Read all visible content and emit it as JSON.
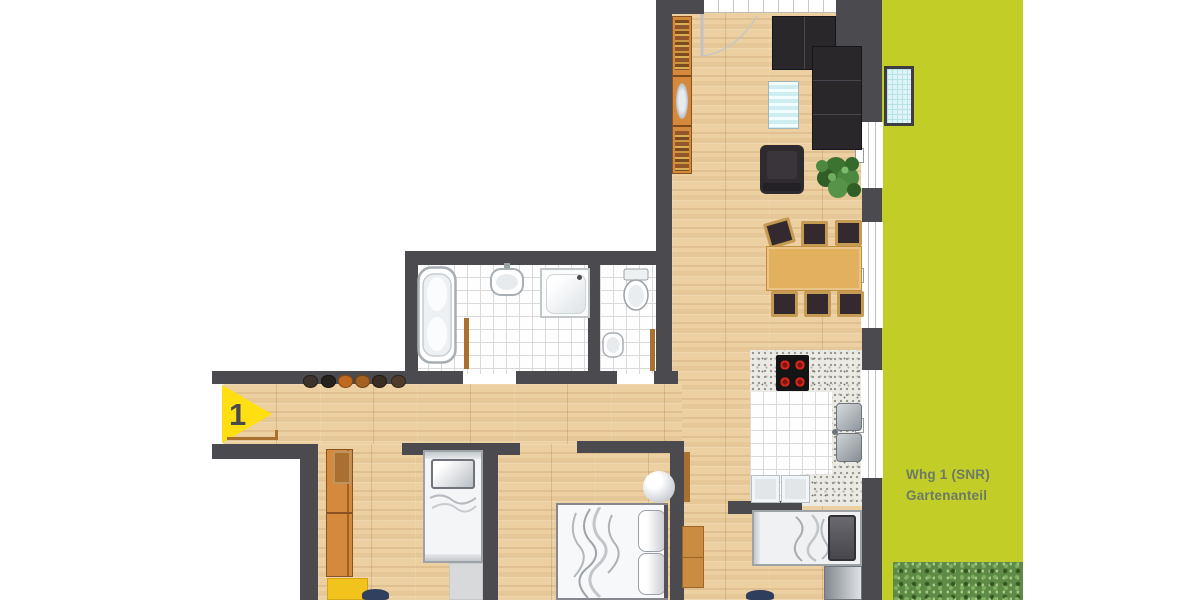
{
  "labels": {
    "unit_marker": "1",
    "garden_line1": "Whg 1 (SNR)",
    "garden_line2": "Gartenanteil"
  },
  "colors": {
    "wall": "#4b4a4f",
    "wood": "#ecd0a2",
    "garden": "#c2cd28",
    "garden-label": "#6d7a67",
    "hedge": "#5d8a44",
    "marker-yellow": "#ffdf12",
    "marker-number": "#4a4a4e",
    "tile-line": "#dadada",
    "granite": "#eceae4",
    "door-wood": "#a9702f",
    "sofa": "#2a272b",
    "chair-seat": "#33292e",
    "chair-frame": "#c59a52",
    "table-wood": "#e2b15e",
    "wardrobe-orange": "#d5893c",
    "desk-yellow": "#f2c31d",
    "lightwell-blue": "#dff4f7"
  },
  "elements": [
    "entrance-marker",
    "garden-area",
    "hedge",
    "light-well",
    "corner-sofa",
    "coffee-table",
    "armchair",
    "plant",
    "bookshelf",
    "dining-table",
    "dining-chair",
    "cooktop",
    "kitchen-sink",
    "kitchen-appliance",
    "bathtub",
    "washbasin",
    "shower",
    "toilet",
    "wc-basin",
    "single-bed",
    "double-bed",
    "wardrobe",
    "desk",
    "office-chair",
    "closet",
    "nightstand",
    "shoes"
  ]
}
